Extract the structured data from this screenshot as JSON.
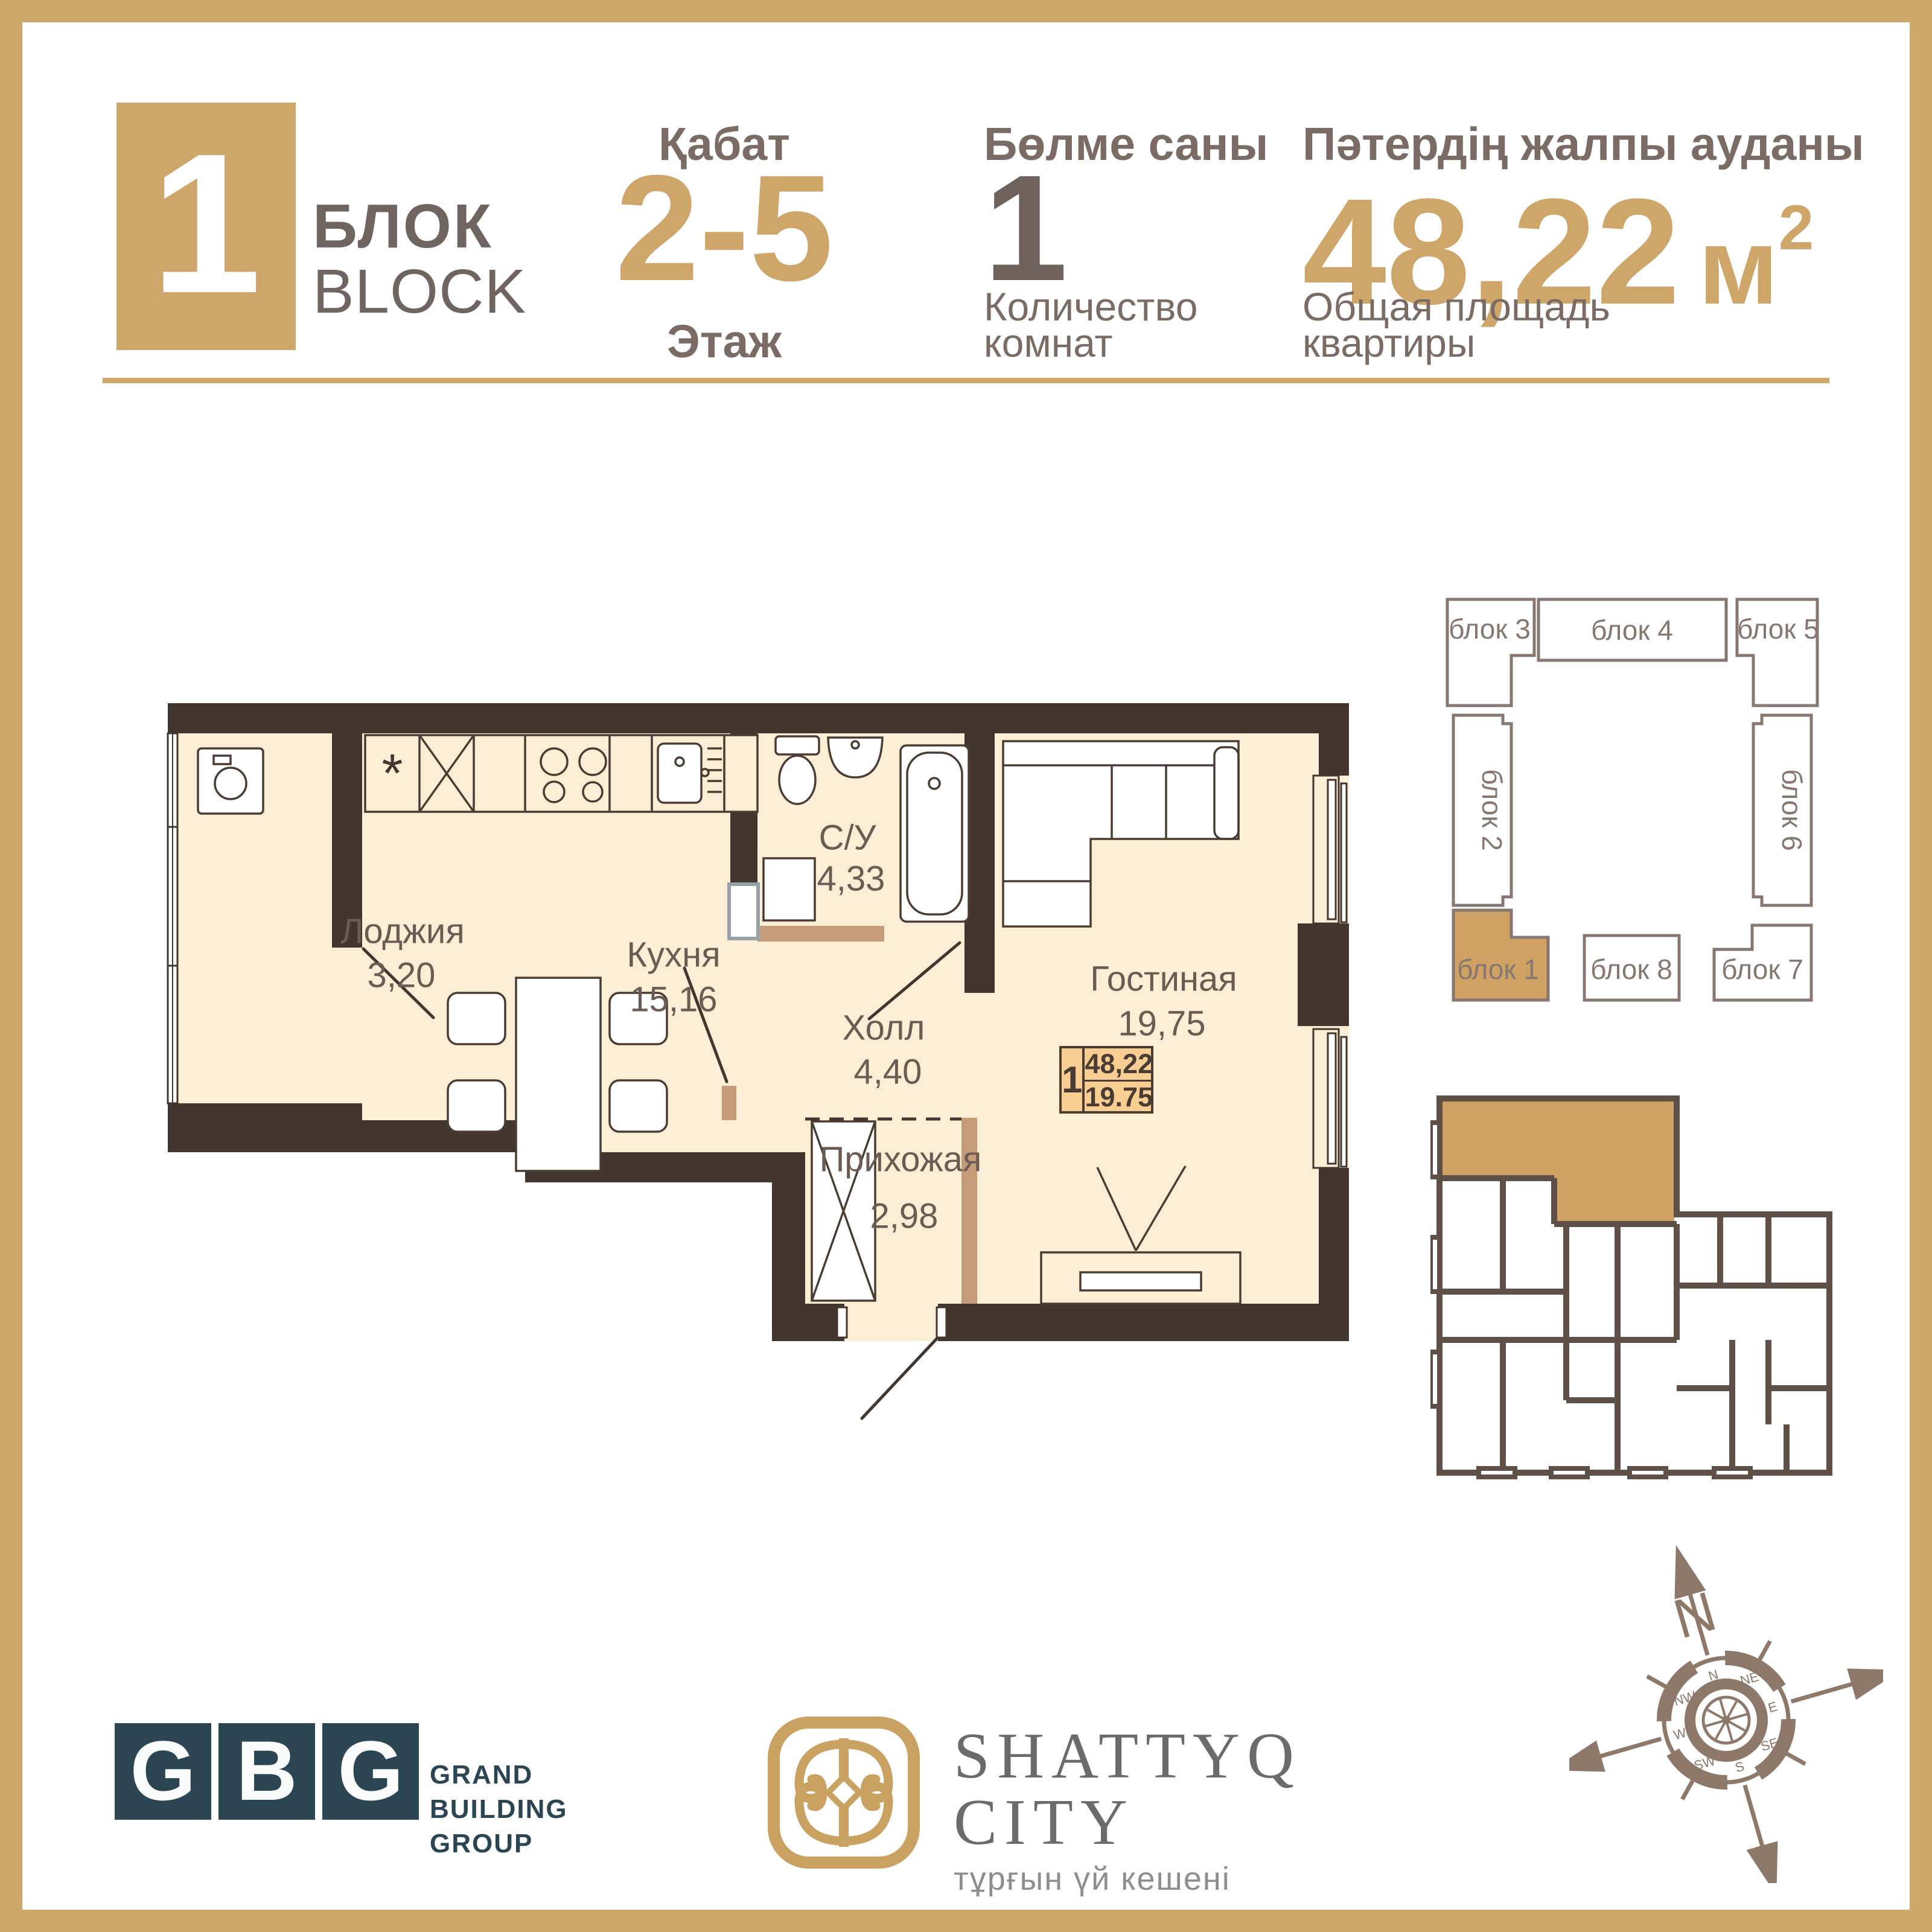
{
  "header": {
    "block_number": "1",
    "block_title_kz": "БЛОК",
    "block_title_en": "BLOCK",
    "floor_label_kz": "Қабат",
    "floor_value": "2-5",
    "floor_label_ru": "Этаж",
    "rooms_label_kz": "Бөлме саны",
    "rooms_value": "1",
    "rooms_label_ru_line1": "Количество",
    "rooms_label_ru_line2": "комнат",
    "area_label_kz": "Пәтердің жалпы ауданы",
    "area_value": "48,22",
    "area_unit": "м",
    "area_unit_sup": "2",
    "area_label_ru_line1": "Общая площадь",
    "area_label_ru_line2": "квартиры"
  },
  "floorplan": {
    "kitchen_symbol": "*",
    "rooms": [
      {
        "name": "Лоджия",
        "area": "3,20"
      },
      {
        "name": "Кухня",
        "area": "15,16"
      },
      {
        "name": "С/У",
        "area": "4,33"
      },
      {
        "name": "Холл",
        "area": "4,40"
      },
      {
        "name": "Гостиная",
        "area": "19,75"
      },
      {
        "name": "Прихожая",
        "area": "2,98"
      }
    ],
    "badge": {
      "rooms": "1",
      "total": "48,22",
      "living": "19.75"
    }
  },
  "site": {
    "highlight": "блок 1",
    "blocks": [
      {
        "label": "блок 1"
      },
      {
        "label": "блок 2"
      },
      {
        "label": "блок 3"
      },
      {
        "label": "блок 4"
      },
      {
        "label": "блок 5"
      },
      {
        "label": "блок 6"
      },
      {
        "label": "блок 7"
      },
      {
        "label": "блок 8"
      }
    ]
  },
  "footer": {
    "gbg_letters": [
      "G",
      "B",
      "G"
    ],
    "gbg_name": [
      "GRAND",
      "BUILDING",
      "GROUP"
    ],
    "project_title_1": "SHATTYQ",
    "project_title_2": "CITY",
    "project_subtitle": "тұрғын үй кешені",
    "compass_north": "N",
    "compass_dirs": [
      "N",
      "NE",
      "E",
      "SE",
      "S",
      "SW",
      "W",
      "NW"
    ]
  },
  "colors": {
    "gold": "#CEA66A",
    "taupe_text": "#7A6B64",
    "wall_dark": "#42362F",
    "partition_tan": "#C69B78",
    "floor_cream": "#FBEED4",
    "badge_fill": "#F8CE93",
    "site_outline": "#877770",
    "gbg_teal": "#2B4652",
    "compass": "#8D7869",
    "shattyq_gray": "#6B6B6B"
  }
}
